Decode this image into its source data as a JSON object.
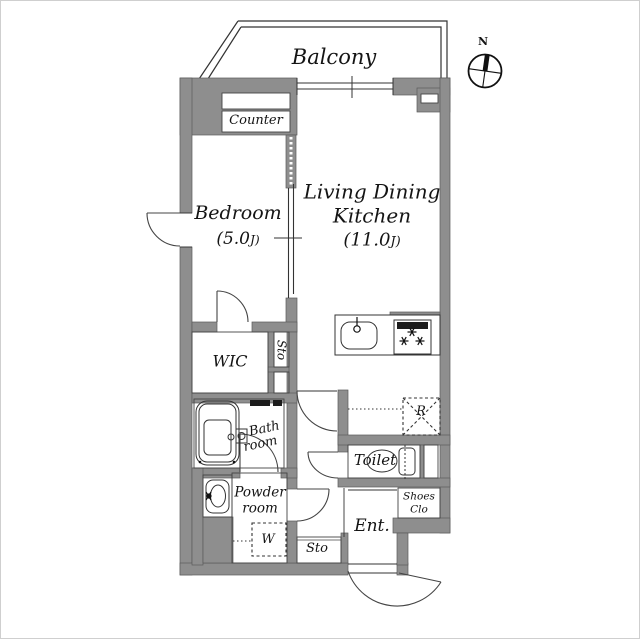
{
  "plan": {
    "balcony_label": "Balcony",
    "compass": {
      "north_label": "N"
    },
    "rooms": {
      "bedroom": {
        "name": "Bedroom",
        "size_main": "(5.0",
        "size_unit": "J)"
      },
      "ldk": {
        "name_line1": "Living Dining",
        "name_line2": "Kitchen",
        "size_main": "(11.0",
        "size_unit": "J)"
      },
      "counter": {
        "label": "Counter"
      },
      "wic": {
        "label": "WIC"
      },
      "storage_upper": {
        "label": "Sto"
      },
      "bathroom": {
        "label_line1": "Bath",
        "label_line2": "room"
      },
      "powder_room": {
        "label_line1": "Powder",
        "label_line2": "room"
      },
      "toilet": {
        "label": "Toilet"
      },
      "entrance": {
        "label": "Ent."
      },
      "shoes_closet": {
        "label_line1": "Shoes",
        "label_line2": "Clo"
      },
      "storage_lower": {
        "label": "Sto"
      }
    },
    "markers": {
      "washer_space": {
        "label": "W"
      },
      "fridge_space": {
        "label": "R"
      }
    },
    "colors": {
      "wall": "#8e8e8e",
      "wall_edge": "#5a5a5a",
      "line": "#333333",
      "text": "#141414"
    }
  }
}
